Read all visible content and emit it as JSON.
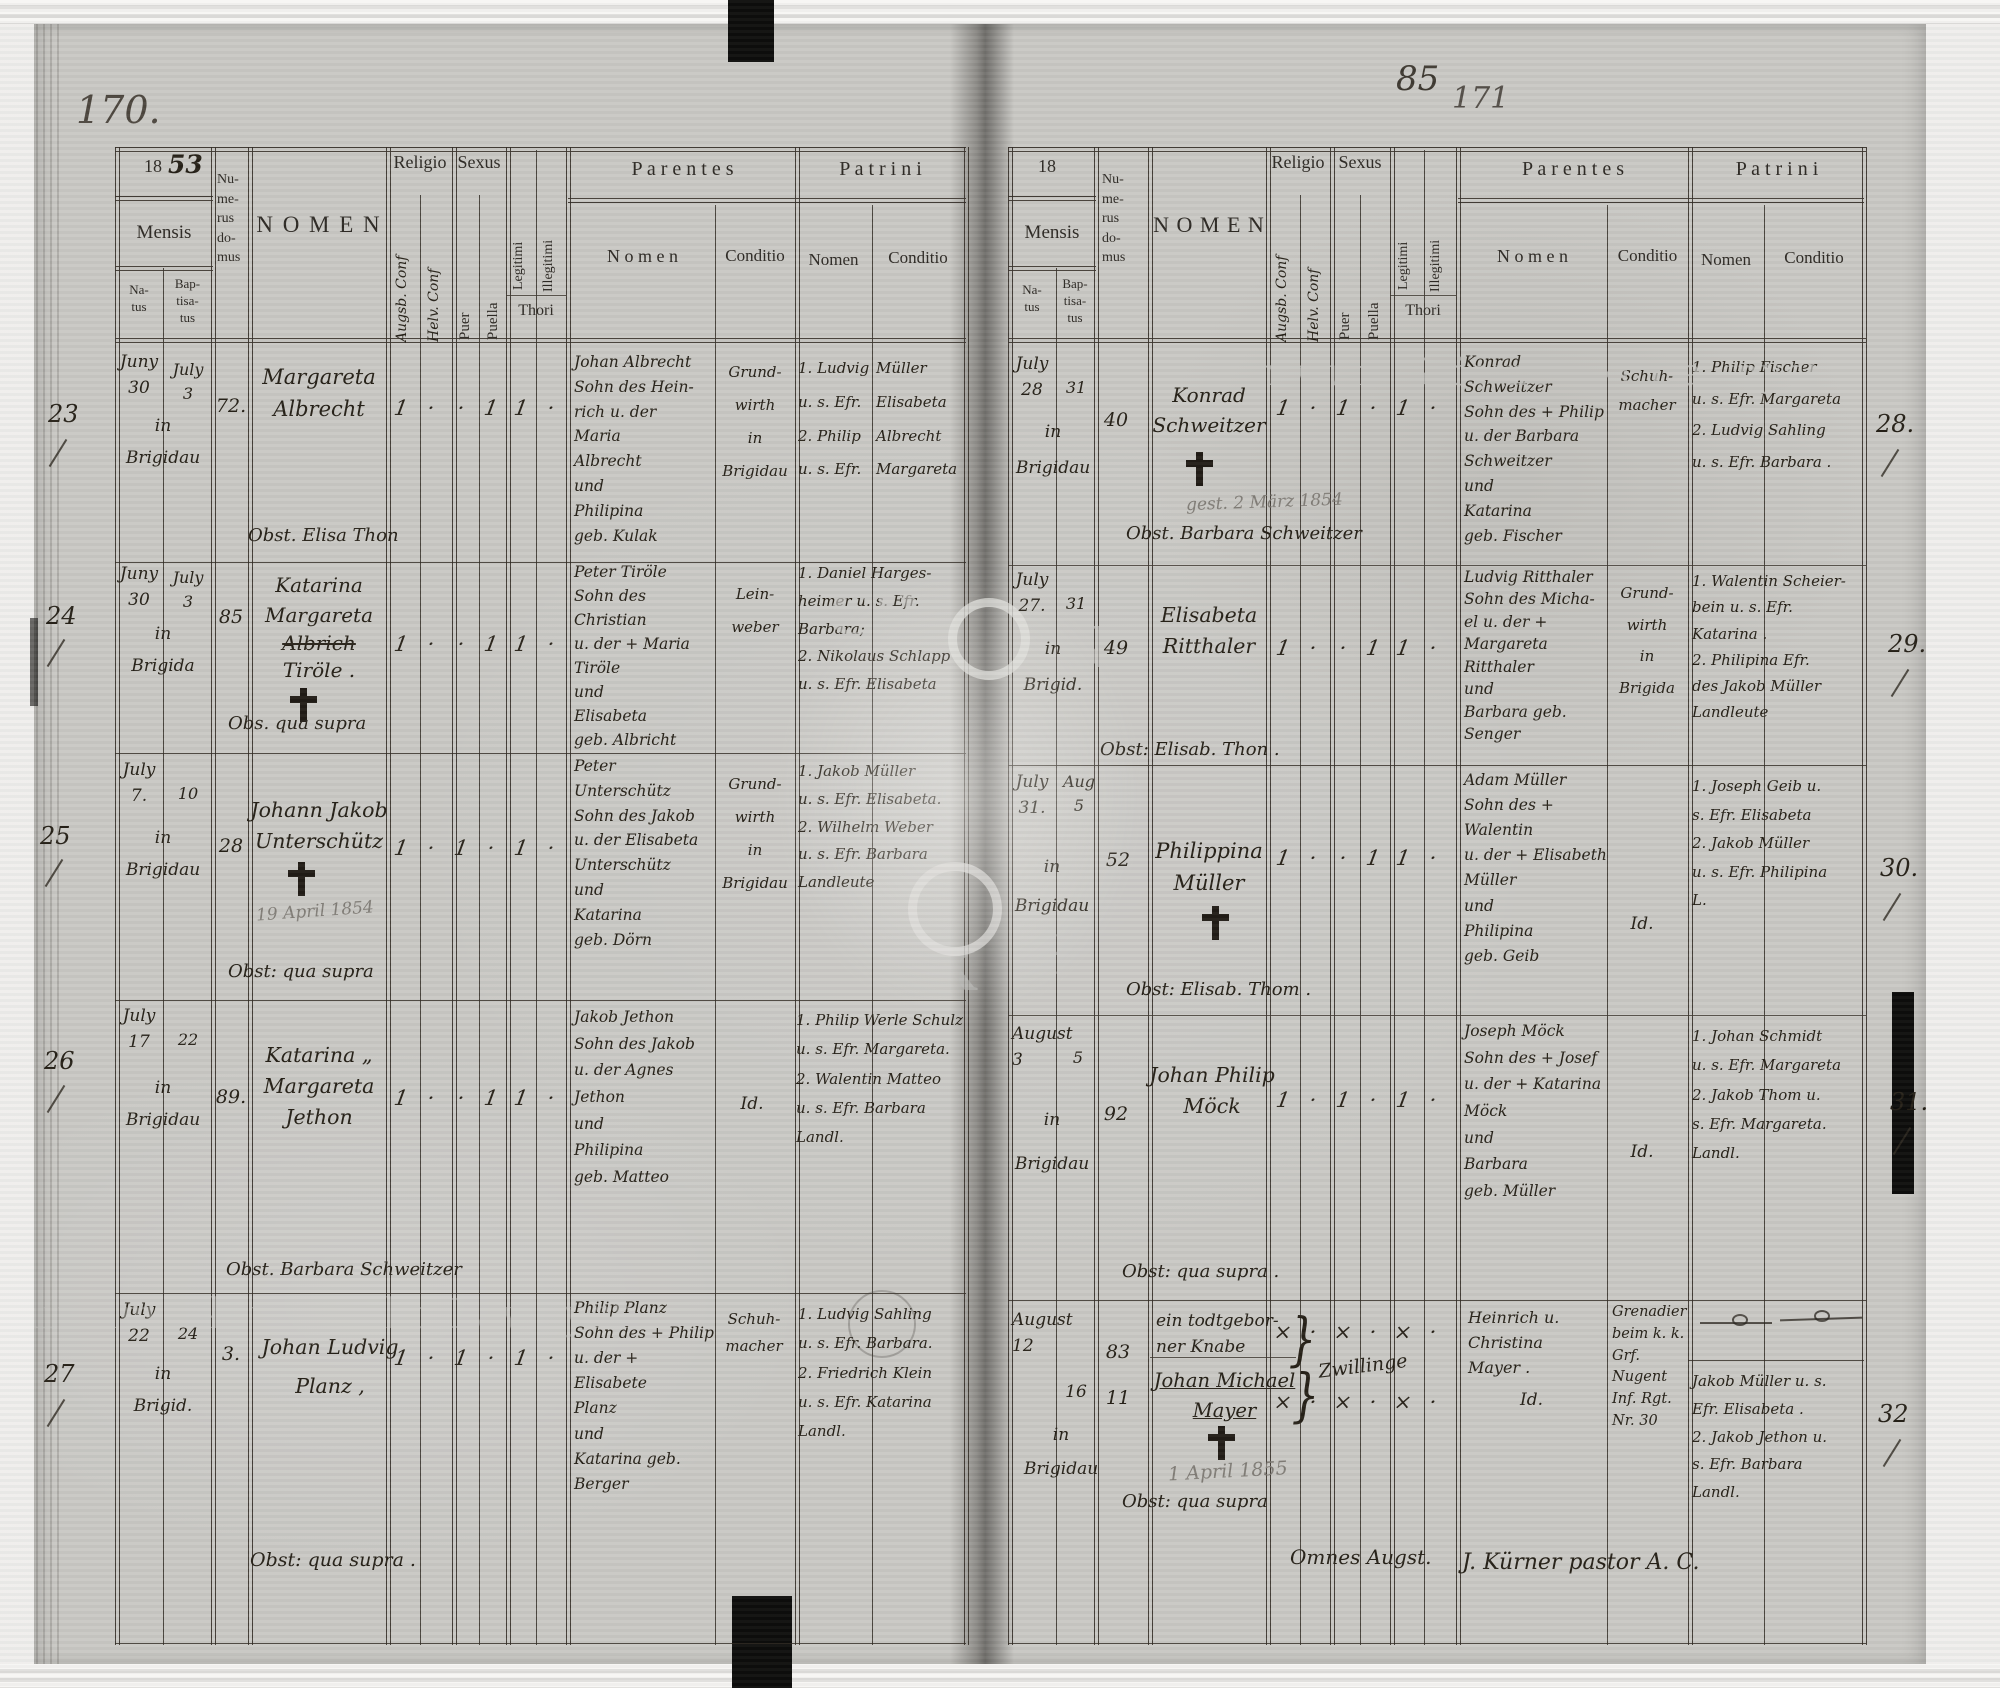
{
  "watermark": {
    "text": "Archiwum Główne Akt Dawnych",
    "letters": [
      "CH",
      "N",
      "AK",
      "H"
    ]
  },
  "header": {
    "mensis": "Mensis",
    "natus": "Na-\ntus",
    "baptisatus": "Bap-\ntisa-\ntus",
    "numerus": "Nu-\nme-\nrus\ndo-\nmus",
    "nomen": "N O M E N",
    "religio": "Religio",
    "religio_sub1": "Augsb. Conf",
    "religio_sub2": "Helv. Conf",
    "sexus": "Sexus",
    "puer": "Puer",
    "puella": "Puella",
    "legitimi": "Legitimi",
    "illegitimi": "Illegitimi",
    "thori": "Thori",
    "parentes": "P a r e n t e s",
    "patrini": "P a t r i n i",
    "sub_nomen": "N o m e n",
    "sub_conditio": "Conditio",
    "patrini_nomen": "Nomen",
    "patrini_conditio": "Conditio",
    "year_printed": "18"
  },
  "page_left": {
    "folio": "170.",
    "year_hand": "53",
    "records": [
      {
        "no": "23",
        "natus": "Juny\n30",
        "bapt": "July\n3",
        "place": "in\nBrigidau",
        "house": "72.",
        "name": "Margareta\nAlbrecht",
        "marks": [
          "1",
          "·",
          "·",
          "1",
          "1",
          "·"
        ],
        "parentes": "Johan Albrecht\nSohn des Hein-\nrich u. der\nMaria\nAlbrecht\nund\nPhilipina\ngeb. Kulak",
        "conditio": "Grund-\nwirth\nin\nBrigidau",
        "patrini": "1. Ludvig\nu. s. Efr.\n2. Philip\nu. s. Efr.",
        "patrini_cond": "Müller\nElisabeta\nAlbrecht\nMargareta",
        "obst": "Obst. Elisa Thon"
      },
      {
        "no": "24",
        "natus": "Juny\n30",
        "bapt": "July\n3",
        "place": "in\nBrigida",
        "house": "85",
        "name": "Katarina\nMargareta",
        "struck": "Albrich",
        "name2": "Tiröle .",
        "marks": [
          "1",
          "·",
          "·",
          "1",
          "1",
          "·"
        ],
        "parentes": "Peter Tiröle\nSohn des Christian\nu. der + Maria\nTiröle\nund\nElisabeta\ngeb. Albricht",
        "conditio": "Lein-\nweber",
        "patrini_wide": "1. Daniel Harges-\nheimer u. s. Efr.\nBarbara;\n2. Nikolaus Schlapp\nu. s. Efr. Elisabeta",
        "obst": "Obs. qua supra"
      },
      {
        "no": "25",
        "natus": "July\n7.",
        "bapt": "\n10",
        "place": "in\nBrigidau",
        "house": "28",
        "name": "Johann Jakob\nUnterschütz",
        "pencil": "19 April 1854",
        "marks": [
          "1",
          "·",
          "1",
          "·",
          "1",
          "·"
        ],
        "parentes": "Peter Unterschütz\nSohn des Jakob\nu. der Elisabeta\nUnterschütz\nund\nKatarina\ngeb. Dörn",
        "conditio": "Grund-\nwirth\nin\nBrigidau",
        "patrini_wide": "1. Jakob Müller\nu. s. Efr. Elisabeta.\n2. Wilhelm Weber\nu. s. Efr. Barbara\nLandleute",
        "obst": "Obst: qua supra"
      },
      {
        "no": "26",
        "natus": "July\n17",
        "bapt": "\n22",
        "place": "in\nBrigidau",
        "house": "89.",
        "name": "Katarina „\nMargareta\nJethon",
        "marks": [
          "1",
          "·",
          "·",
          "1",
          "1",
          "·"
        ],
        "parentes": "Jakob Jethon\nSohn des Jakob\nu. der Agnes\nJethon\nund\nPhilipina\ngeb. Matteo",
        "conditio": "Id.",
        "patrini_wide": "1. Philip Werle Schulz\nu. s. Efr. Margareta.\n2. Walentin Matteo\nu. s. Efr. Barbara\nLandl.",
        "obst": "Obst. Barbara Schweitzer"
      },
      {
        "no": "27",
        "natus": "July\n22",
        "bapt": "\n24",
        "place": "in\nBrigid.",
        "house": "3.",
        "name": "Johan Ludvig\nPlanz ,",
        "marks": [
          "1",
          "·",
          "1",
          "·",
          "1",
          "·"
        ],
        "parentes": "Philip Planz\nSohn des + Philip\nu. der + Elisabete\nPlanz\nund\nKatarina geb.\nBerger",
        "conditio": "Schuh-\nmacher",
        "patrini_wide": "1. Ludvig Sahling\nu. s. Efr. Barbara.\n2. Friedrich Klein\nu. s. Efr. Katarina\nLandl.",
        "obst": "Obst: qua supra ."
      }
    ]
  },
  "page_right": {
    "folio_ink": "85",
    "folio_pencil": "171",
    "records": [
      {
        "no": "28.",
        "natus": "July\n28",
        "bapt": "\n31",
        "place": "in\nBrigidau",
        "house": "40",
        "name": "Konrad\nSchweitzer",
        "pencil": "gest. 2 März 1854",
        "marks": [
          "1",
          "·",
          "1",
          "·",
          "1",
          "·"
        ],
        "parentes": "Konrad Schweitzer\nSohn des + Philip\nu. der Barbara\nSchweitzer\nund\nKatarina\ngeb. Fischer",
        "conditio": "Schuh-\nmacher",
        "patrini_wide": "1. Philip Fischer\nu. s. Efr. Margareta\n2. Ludvig Sahling\nu. s. Efr. Barbara .",
        "obst": "Obst. Barbara Schweitzer"
      },
      {
        "no": "29.",
        "natus": "July\n27.",
        "bapt": "\n31",
        "place": "in\nBrigid.",
        "house": "49",
        "name": "Elisabeta\nRitthaler",
        "marks": [
          "1",
          "·",
          "·",
          "1",
          "1",
          "·"
        ],
        "parentes": "Ludvig Ritthaler\nSohn des Micha-\nel u. der +\nMargareta\nRitthaler\nund\nBarbara geb.\nSenger",
        "conditio": "Grund-\nwirth\nin\nBrigida",
        "patrini_wide": "1. Walentin Scheier-\nbein u. s. Efr.\nKatarina .\n2. Philipina Efr.\ndes Jakob Müller\nLandleute",
        "obst": "Obst: Elisab. Thon ."
      },
      {
        "no": "30.",
        "natus": "July\n31.",
        "bapt": "Aug\n5",
        "place": "in\nBrigidau",
        "house": "52",
        "name": "Philippina\nMüller",
        "marks": [
          "1",
          "·",
          "·",
          "1",
          "1",
          "·"
        ],
        "parentes": "Adam Müller\nSohn des + Walentin\nu. der + Elisabeth\nMüller\nund\nPhilipina\ngeb. Geib",
        "conditio": "Id.",
        "patrini_wide": "1. Joseph Geib u.\ns. Efr. Elisabeta\n2. Jakob Müller\nu. s. Efr. Philipina\nL.",
        "obst": "Obst: Elisab. Thom ."
      },
      {
        "no": "31.",
        "natus": "August\n3",
        "bapt": "\n5",
        "place": "in\nBrigidau",
        "house": "92",
        "name": "Johan Philip\nMöck",
        "marks": [
          "1",
          "·",
          "1",
          "·",
          "1",
          "·"
        ],
        "parentes": "Joseph Möck\nSohn des + Josef\nu. der + Katarina\nMöck\nund\nBarbara\ngeb. Müller",
        "conditio": "Id.",
        "patrini_wide": "1. Johan Schmidt\nu. s. Efr. Margareta\n2. Jakob Thom u.\ns. Efr. Margareta.\nLandl.",
        "obst": "Obst: qua supra ."
      },
      {
        "no": "32",
        "natusA": "August\n12",
        "houseA": "83",
        "nameA": "ein todtgebor-\nner Knabe",
        "marksA": [
          "×",
          "·",
          "×",
          "·",
          "×",
          "·"
        ],
        "baptB": "16",
        "houseB": "11",
        "nameB1": "Johan Michael",
        "nameB2": "Mayer",
        "pencil": "1 April 1855",
        "place": "in\nBrigidau",
        "marksB": [
          "×",
          "·",
          "×",
          "·",
          "×",
          "·"
        ],
        "twin_note": "Zwillinge",
        "twin_brace": "}",
        "parentes": "Heinrich u.\nChristina\nMayer .",
        "parentes_idem": "Id.",
        "conditio": "Grenadier\nbeim k. k.\nGrf. Nugent\nInf. Rgt.\nNr. 30",
        "patrini_wide": "Jakob Müller u. s.\nEfr. Elisabeta .\n2. Jakob Jethon u.\ns. Efr. Barbara\nLandl.",
        "obst": "Obst: qua supra"
      }
    ]
  },
  "footer": {
    "omnes": "Omnes Augst.",
    "pastor": "J. Kürner pastor A. C."
  }
}
